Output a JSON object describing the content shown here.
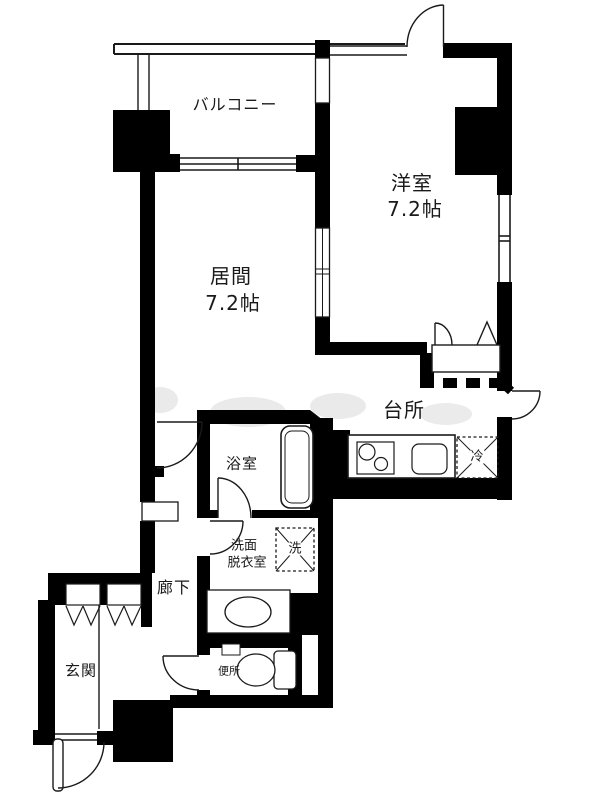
{
  "floorplan": {
    "rooms": {
      "balcony": {
        "label": "バルコニー"
      },
      "western": {
        "label": "洋室",
        "size": "7.2帖"
      },
      "living": {
        "label": "居間",
        "size": "7.2帖"
      },
      "kitchen": {
        "label": "台所"
      },
      "bathroom": {
        "label": "浴室"
      },
      "washroom": {
        "label_line1": "洗面",
        "label_line2": "脱衣室"
      },
      "hallway": {
        "label": "廊下"
      },
      "entrance": {
        "label": "玄関"
      },
      "toilet": {
        "label": "便所"
      }
    },
    "fixtures": {
      "washer": {
        "label": "洗"
      },
      "refrigerator": {
        "label": "冷"
      }
    },
    "colors": {
      "wall": "#000000",
      "floor": "#ffffff",
      "thin_line": "#1a1a1a",
      "watermark": "#cccccc"
    }
  }
}
